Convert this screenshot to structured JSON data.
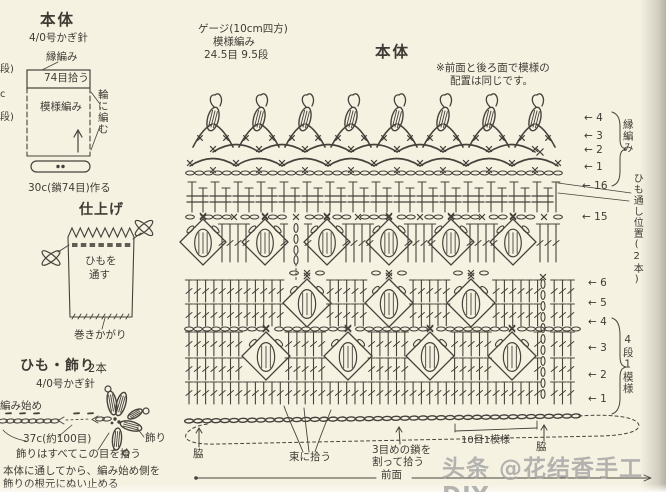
{
  "colors": {
    "ink": "#46423b",
    "bg": "#f6f2e2",
    "watermark": "#a3a3a3"
  },
  "watermark": "头条 @花结香手工DIY",
  "left": {
    "body": {
      "title": "本体",
      "hook": "4/0号かぎ針",
      "edge": "縁編み",
      "pickup": "74目拾う",
      "pattern": "模様編み",
      "round": "輪に編む",
      "foundation": "30c(鎖74目)作る",
      "frag_top": "段)",
      "frag_mid": "c",
      "frag_bottom": "段)"
    },
    "finish": {
      "title": "仕上げ",
      "thread1": "ひもを",
      "thread2": "通す",
      "whip": "巻きかがり"
    },
    "cord": {
      "title": "ひも・飾り",
      "count": "2本",
      "hook": "4/0号かぎ針",
      "start": "編み始め",
      "length": "37c(約100目)",
      "pickup_note": "飾りはすべてこの目を拾う",
      "deco": "飾り",
      "note1": "本体に通してから、編み始め側を",
      "note2": "飾りの根元にぬい止める"
    }
  },
  "chart": {
    "gauge1": "ゲージ(10cm四方)",
    "gauge2": "模様編み",
    "gauge3": "24.5目  9.5段",
    "title": "本体",
    "note1": "※前面と後ろ面で模様の",
    "note2": "配置は同じです。",
    "edge_bracket": "縁編み",
    "cord_pos": "ひも通し位置(2本)",
    "repeat_bracket": "4段1模様",
    "arrow": "←",
    "edge_rows": [
      {
        "n": "4",
        "y": 118
      },
      {
        "n": "3",
        "y": 136
      },
      {
        "n": "2",
        "y": 150
      },
      {
        "n": "1",
        "y": 167
      }
    ],
    "mid_rows": [
      {
        "n": "16",
        "y": 186
      },
      {
        "n": "15",
        "y": 217
      }
    ],
    "lower_rows": [
      {
        "n": "6",
        "y": 283
      },
      {
        "n": "5",
        "y": 303
      },
      {
        "n": "4",
        "y": 322
      },
      {
        "n": "3",
        "y": 348
      },
      {
        "n": "2",
        "y": 375
      },
      {
        "n": "1",
        "y": 399
      }
    ],
    "bottom": {
      "side_l": "脇",
      "bundle": "束に拾う",
      "split1": "3目めの鎖を",
      "split2": "割って拾う",
      "front": "前面",
      "rep10": "10目1模様",
      "side_r": "脇"
    }
  }
}
